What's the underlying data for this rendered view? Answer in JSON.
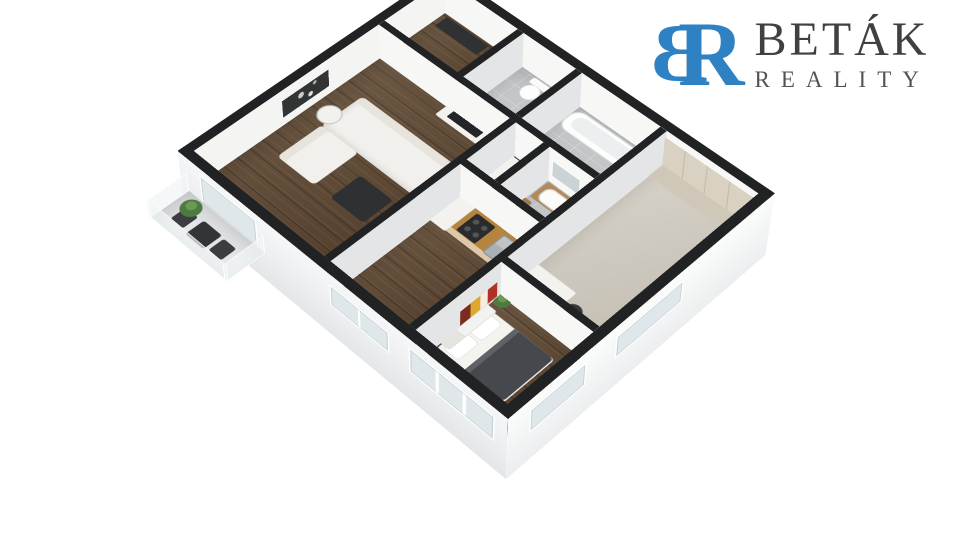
{
  "logo": {
    "monogram_b": "B",
    "monogram_r": "R",
    "name": "BETÁK",
    "subtitle": "REALITY"
  },
  "colors": {
    "brand_blue": "#2e82c4",
    "logo_text": "#3e4042",
    "logo_sub": "#515358",
    "wall_top": "#212224",
    "wall_bright": "#f7f7f6",
    "wall_shade": "#e4e5e6",
    "wood": "#5e4730",
    "gray_floor": "#c3c5c6",
    "carpet": "#cfc9bd",
    "balcony_floor": "#e3e5e6",
    "glass": "#dfe7ea",
    "furn_dark": "#2e3032",
    "sofa": "#f2f0ec",
    "blanket": "#45494d",
    "counter": "#b5853f",
    "cabinet_tan": "#b08a5a",
    "wardrobe": "#d9d2c2",
    "plant": "#4d7a3f",
    "steel": "#aab0b3",
    "art_red": "#b03227",
    "art_yellow": "#dca82e",
    "mirror": "#ccd3d6"
  }
}
